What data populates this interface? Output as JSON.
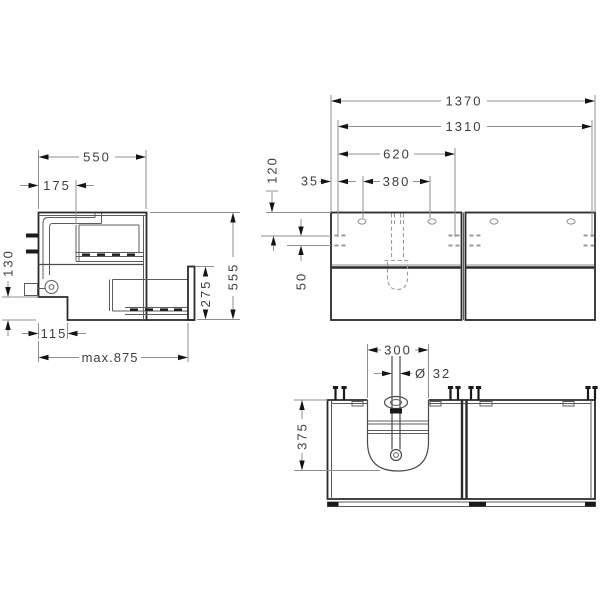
{
  "drawing": {
    "kind": "technical dimension drawing",
    "subject": "wall-mounted double vanity unit with two drawers (side, front and bottom views)",
    "units": "mm",
    "colors": {
      "background": "#ffffff",
      "object_line": "#2a2a2a",
      "detail_line": "#5c5c5c",
      "dimension_line": "#8f8f8f",
      "arrow": "#141414",
      "text": "#3d3d3d"
    },
    "views": {
      "side": {
        "label": "side view",
        "dims": {
          "depth": "550",
          "drain_offset": "175",
          "recess_height": "130",
          "recess_depth": "115",
          "max_depth_open": "max.875",
          "drawer_front_height": "275",
          "height": "555"
        }
      },
      "front": {
        "label": "front view",
        "dims": {
          "total_width": "1370",
          "mounting_span": "1310",
          "left_section": "620",
          "hole_spacing": "380",
          "edge_offset": "35",
          "top_offset": "120",
          "rail_spacing": "50"
        }
      },
      "bottom": {
        "label": "bottom view",
        "dims": {
          "cutout_width": "300",
          "pipe_diameter": "Ø 32",
          "cutout_depth": "375"
        }
      }
    }
  }
}
